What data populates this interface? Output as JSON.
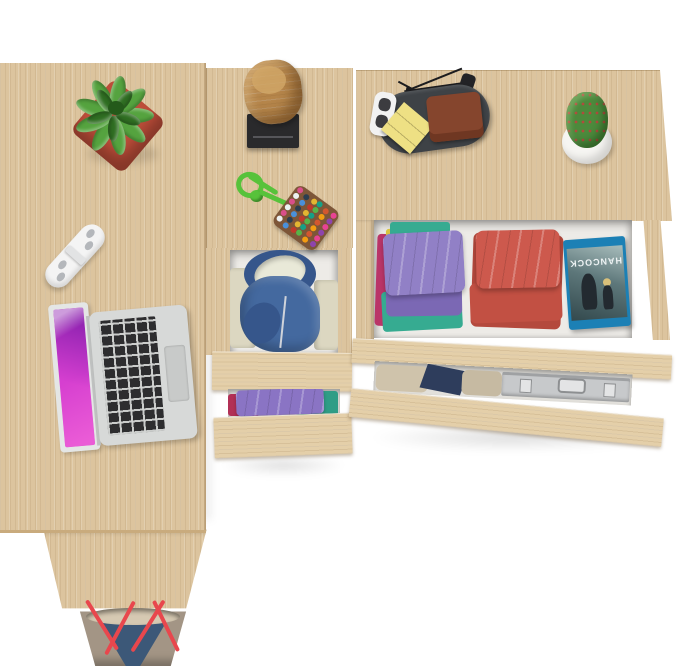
{
  "scene": {
    "description": "Top-down product photo of a light-oak corner desk with drawer tower and wide drawer unit, drawers open showing folded clothes and accessories",
    "background": "#ffffff"
  },
  "palette": {
    "wood": "#dcc49e",
    "wood_light": "#e4cfa9",
    "wood_edge": "#c2a272",
    "interior": "#edebe7",
    "interior_dim": "#e2e0db"
  },
  "objects": {
    "desk": {
      "label": "corner-desk-surface"
    },
    "leg": {
      "label": "desk-leg-panel"
    },
    "succulent": {
      "label": "succulent-in-red-pot",
      "pot": "#bf4e3a",
      "pot_dark": "#a03c2c",
      "leaf": "#55a33f",
      "leaf_dark": "#2f6e22",
      "center": "#245a1a"
    },
    "wall_hook": {
      "label": "white-wall-hook",
      "body": "#f4f4f4",
      "dots": "#b4b7bb"
    },
    "laptop": {
      "label": "open-silver-laptop",
      "body": "#d7d9d8",
      "lid": "#e4e6e5",
      "hinge": "#bfc1c0",
      "keys": "#2d2d2f",
      "trackpad": "#c8cac9",
      "screen": "#d63fd0"
    },
    "stump": {
      "label": "wooden-log-decor",
      "bark": "#b5854a",
      "top": "#d2a768",
      "plate": "#2a2a2c",
      "slot": "#56565a"
    },
    "pompom": {
      "label": "pompom-bead-keychain",
      "cord": "#57c23b",
      "pad": "#7d5638",
      "beads": [
        "#d94f8a",
        "#4a90d9",
        "#e3b531",
        "#58b348",
        "#d3572f",
        "#8e44ad",
        "#ecf0f1",
        "#2c3e50",
        "#c0392b",
        "#16a085",
        "#f39c12",
        "#e84393"
      ]
    },
    "tray": {
      "label": "valet-tray",
      "base": "#3e4246",
      "sticky": "#eee084",
      "wallet": "#85452d",
      "wallet_dark": "#6f3722",
      "glasses": "#f2f2f2",
      "lens": "#3c3c40",
      "branch": "#1c1c1e",
      "key": "#232326"
    },
    "cactus": {
      "label": "cactus-in-white-pot",
      "body": "#4c8a3c",
      "spines": "#b24a3c",
      "pot": "#f6f5f2"
    },
    "drawer1_clothes": {
      "label": "folded-clothes-stacks",
      "purple": "#9180c6",
      "purple_dark": "#7b68b4",
      "teal": "#36ab91",
      "magenta": "#ba3568",
      "yellow": "#d8c33e",
      "red": "#cd594d",
      "red_mid": "#c25043",
      "red_dark": "#b4493d"
    },
    "dvd": {
      "label": "bluray-case",
      "title": "HANCOCK",
      "case": "#1c80b5",
      "art_light": "#a8bdbc",
      "art_dark": "#33494d",
      "figure": "#232a30",
      "hair": "#d9c07a"
    },
    "hoodie": {
      "label": "blue-hoodie-in-drawer",
      "blue": "#44699f",
      "blue_dark": "#36568b",
      "lining": "#e9e9d8",
      "cloth": "#dcd7c1"
    },
    "drawer2_clothes": {
      "label": "clothes-in-lower-drawer",
      "khaki": "#cfc3ab",
      "navy": "#2e3d5c",
      "grey": "#c6baa2"
    },
    "briefcase": {
      "label": "aluminum-briefcase",
      "shell": "#c7c9cb",
      "trim": "#9fa1a3",
      "latch": "#e3e4e5"
    },
    "gap_clothes": {
      "label": "clothes-in-tower-lower-drawer",
      "purple": "#8a74c4",
      "teal": "#2f9d86",
      "crimson": "#b23056"
    },
    "bag": {
      "label": "tote-handbag",
      "suede": "#3c5878",
      "leather": "#a39585",
      "strap": "#e8474d",
      "interior": "#d6c9b2"
    }
  }
}
